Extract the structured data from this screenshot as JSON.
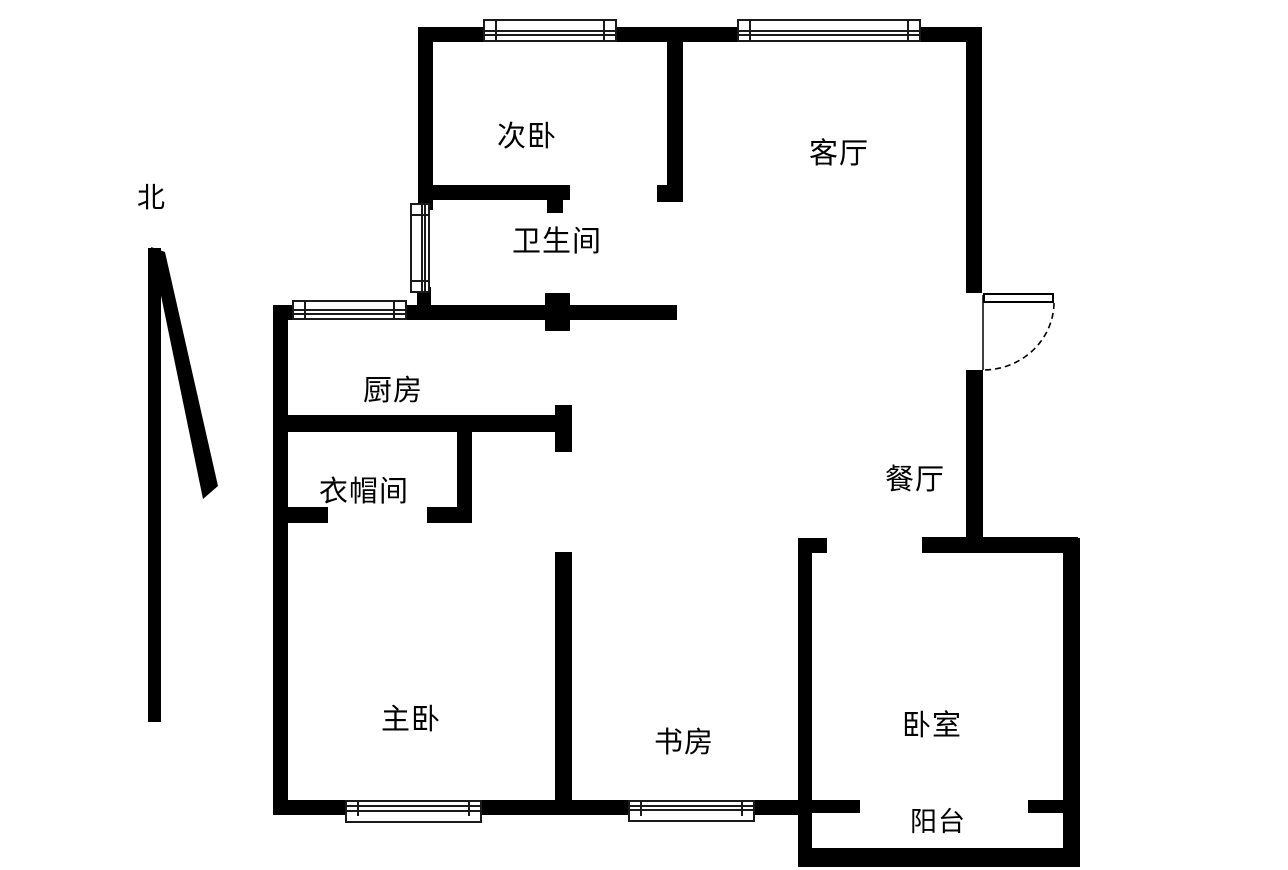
{
  "title": "apartment-floor-plan",
  "compass": {
    "label": "北"
  },
  "rooms": [
    {
      "id": "second-bedroom",
      "label": "次卧"
    },
    {
      "id": "living-room",
      "label": "客厅"
    },
    {
      "id": "bathroom",
      "label": "卫生间"
    },
    {
      "id": "kitchen",
      "label": "厨房"
    },
    {
      "id": "cloakroom",
      "label": "衣帽间"
    },
    {
      "id": "dining-room",
      "label": "餐厅"
    },
    {
      "id": "master-bedroom",
      "label": "主卧"
    },
    {
      "id": "study",
      "label": "书房"
    },
    {
      "id": "bedroom",
      "label": "卧室"
    },
    {
      "id": "balcony",
      "label": "阳台"
    }
  ],
  "colors": {
    "wall": "#000000",
    "background": "#ffffff",
    "text": "#000000"
  }
}
